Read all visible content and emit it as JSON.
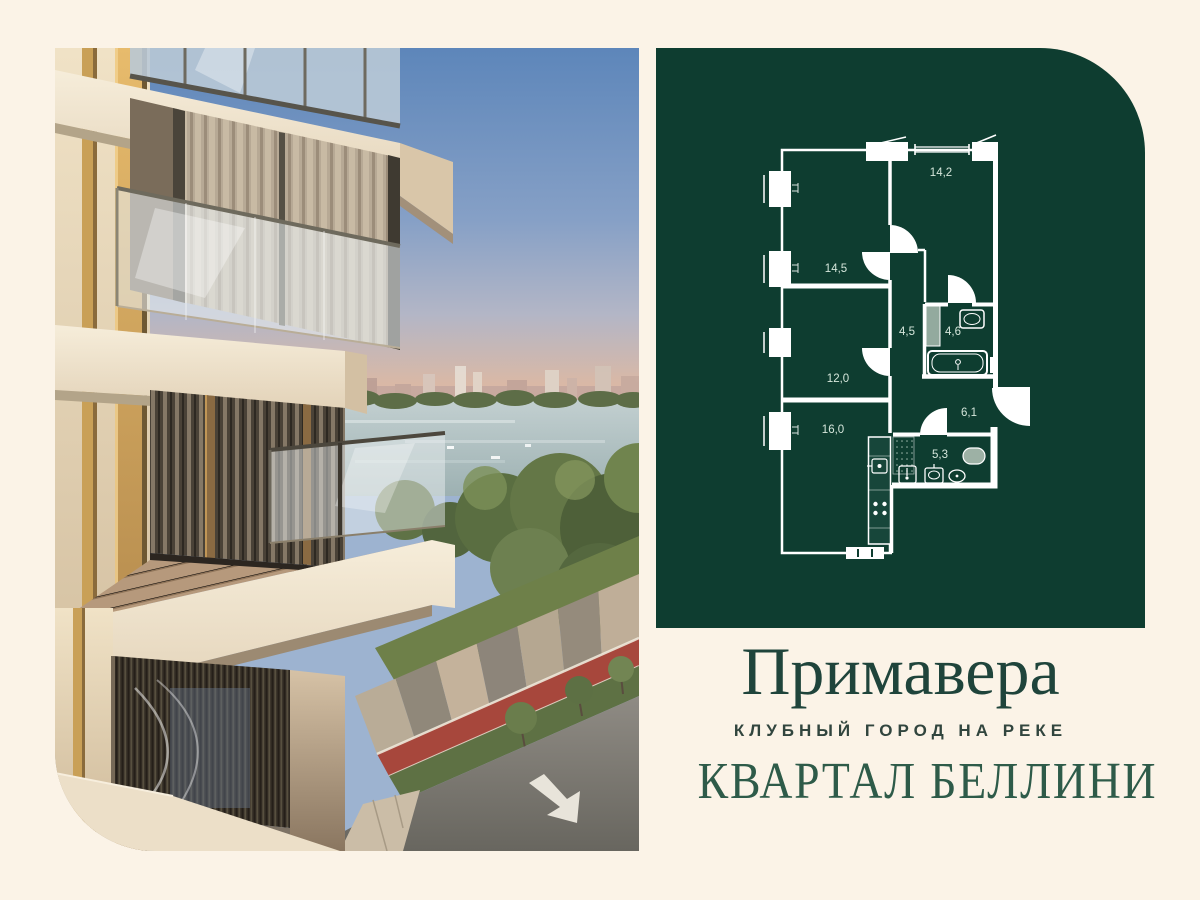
{
  "canvas": {
    "background": "#fbf3e7",
    "width": 1200,
    "height": 900
  },
  "branding": {
    "project_name": "Примавера",
    "tagline": "КЛУБНЫЙ ГОРОД НА РЕКЕ",
    "quarter_name": "КВАРТАЛ БЕЛЛИНИ",
    "project_name_color": "#1f443b",
    "tagline_color": "#31453e",
    "quarter_name_color": "#2e5b49"
  },
  "floor_plan": {
    "panel_color": "#0e3d30",
    "wall_color": "#ffffff",
    "label_color": "#d5e6db",
    "rooms": [
      {
        "id": "bedroom-right",
        "area": "14,2"
      },
      {
        "id": "bedroom-top-left",
        "area": "14,5"
      },
      {
        "id": "corridor",
        "area": "4,5"
      },
      {
        "id": "bathroom",
        "area": "4,6"
      },
      {
        "id": "bedroom-middle-left",
        "area": "12,0"
      },
      {
        "id": "hallway",
        "area": "6,1"
      },
      {
        "id": "living-kitchen",
        "area": "16,0"
      },
      {
        "id": "wc",
        "area": "5,3"
      }
    ]
  },
  "photo": {
    "description": "Render of beige residential tower corner with glass balconies above a river, park trees and a street with red bike lane",
    "sky_color": "#5d86ba",
    "river_color": "#a9bcbe",
    "tree_color": "#5a6e41",
    "road_color": "#76736c",
    "track_color": "#a7473c",
    "facade_color": "#eee3cd",
    "gold_accent": "#c9a057"
  }
}
